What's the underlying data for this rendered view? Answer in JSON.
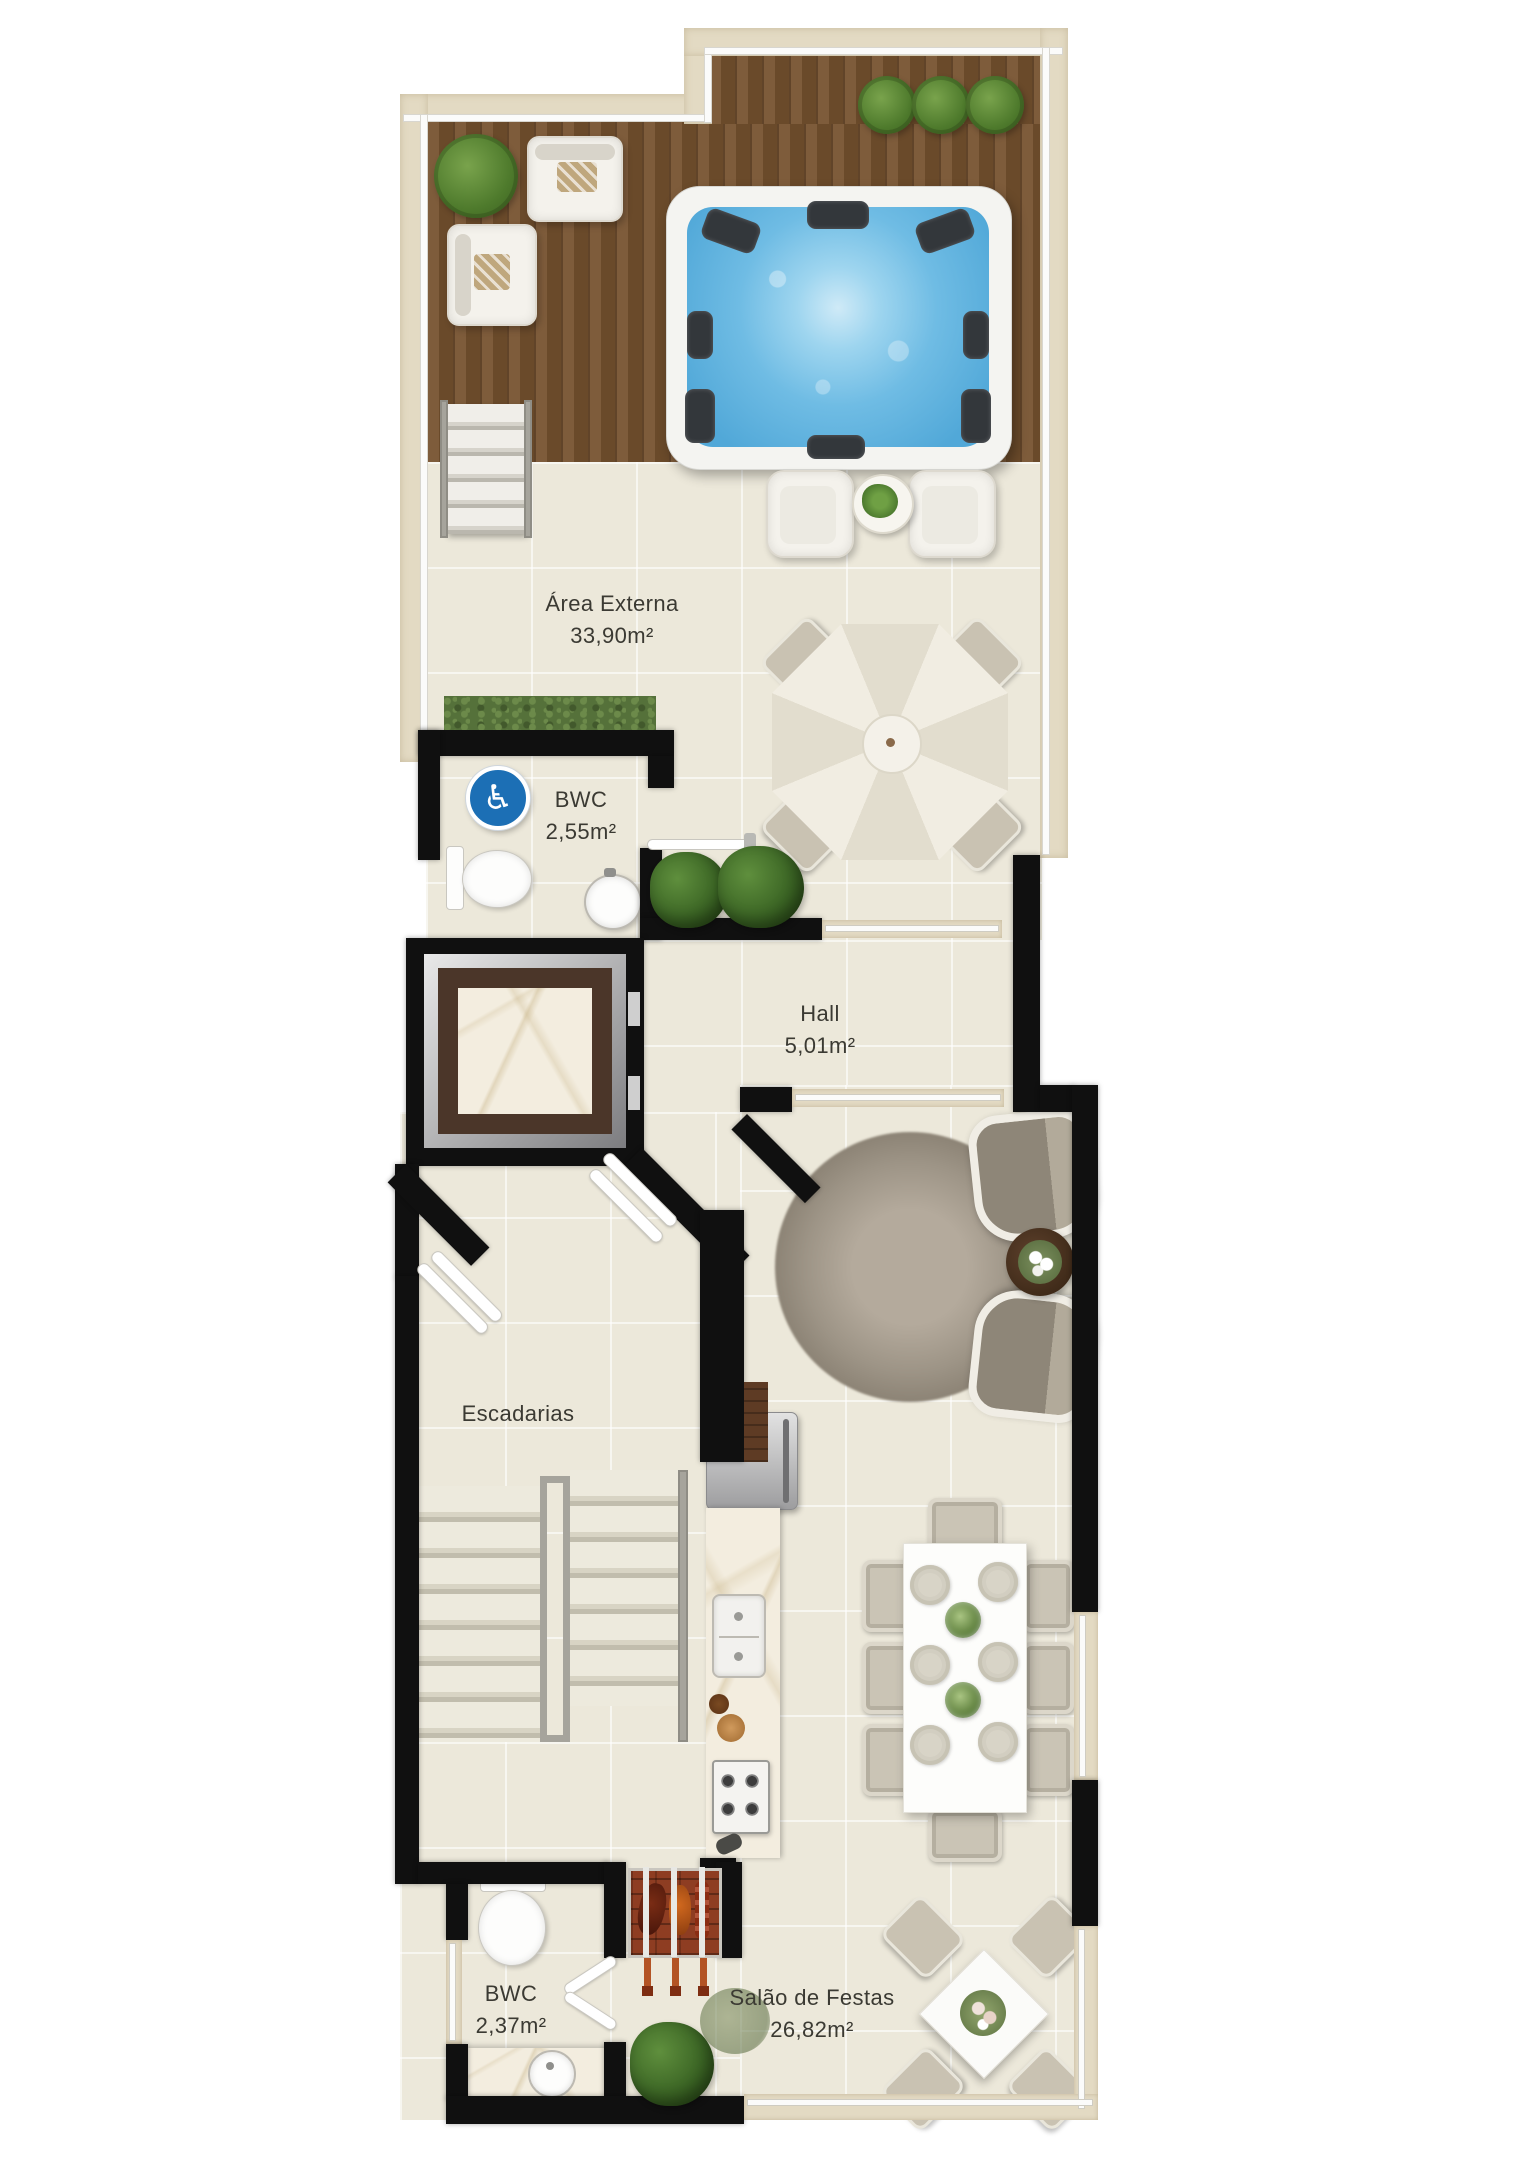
{
  "document": {
    "type": "residential floor plan",
    "language": "pt-BR"
  },
  "rooms": {
    "area_externa": {
      "name": "Área Externa",
      "area": "33,90m²"
    },
    "bwc_superior": {
      "name": "BWC",
      "area": "2,55m²"
    },
    "hall": {
      "name": "Hall",
      "area": "5,01m²"
    },
    "escadarias": {
      "name": "Escadarias",
      "area": ""
    },
    "bwc_inferior": {
      "name": "BWC",
      "area": "2,37m²"
    },
    "salao_de_festas": {
      "name": "Salão de Festas",
      "area": "26,82m²"
    }
  },
  "icons": {
    "accessible": {
      "name": "accessible-icon",
      "glyph": "♿",
      "background": "#1C6FB5"
    }
  },
  "colors": {
    "walls": "#101010",
    "deck_wood": "#76522F",
    "tile_floor": "#ECE8DA",
    "travertine_border": "#E3DAC3",
    "spa_water": "#6FBCE4",
    "hedge_green": "#55713A",
    "marble_counter": "#F3EDDF",
    "elevator_marble_border": "#4B3629",
    "rug_gray": "#9D9486",
    "grill_brick": "#8E3D22",
    "accessible_blue": "#1C6FB5",
    "label_text": "#3B3A33"
  }
}
